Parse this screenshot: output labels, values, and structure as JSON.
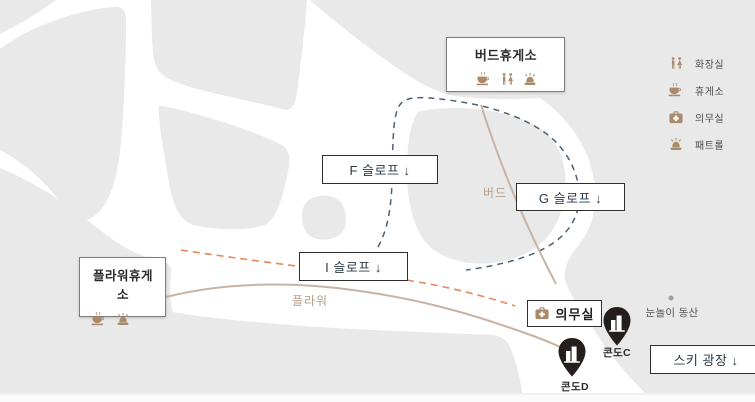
{
  "map": {
    "stations": [
      {
        "id": "bird",
        "label": "버드휴게소"
      },
      {
        "id": "flower",
        "label": "플라워휴게소"
      }
    ],
    "slopes": [
      {
        "id": "f",
        "label": "F 슬로프 ↓"
      },
      {
        "id": "g",
        "label": "G 슬로프 ↓"
      },
      {
        "id": "i",
        "label": "I 슬로프 ↓"
      },
      {
        "id": "ski_plaza",
        "label": "스키 광장 ↓"
      }
    ],
    "medical_room": {
      "label": "의무실"
    },
    "lifts": [
      {
        "label": "버드"
      },
      {
        "label": "플라워"
      }
    ],
    "pins": [
      {
        "label": "콘도C"
      },
      {
        "label": "콘도D"
      }
    ],
    "poi": [
      {
        "label": "눈놀이 동산"
      }
    ]
  },
  "legend": {
    "items": [
      {
        "icon": "toilet-icon",
        "label": "화장실"
      },
      {
        "icon": "rest-icon",
        "label": "휴게소"
      },
      {
        "icon": "medical-icon",
        "label": "의무실"
      },
      {
        "icon": "patrol-icon",
        "label": "패트롤"
      }
    ]
  },
  "colors": {
    "terrain": "#e9e9e9",
    "lift_line": "#c9b2a1",
    "slope_route": "#4d6175",
    "slope_route_secondary": "#e8865c",
    "amenity_icon": "#ab8a6b",
    "pin": "#241f1c"
  }
}
